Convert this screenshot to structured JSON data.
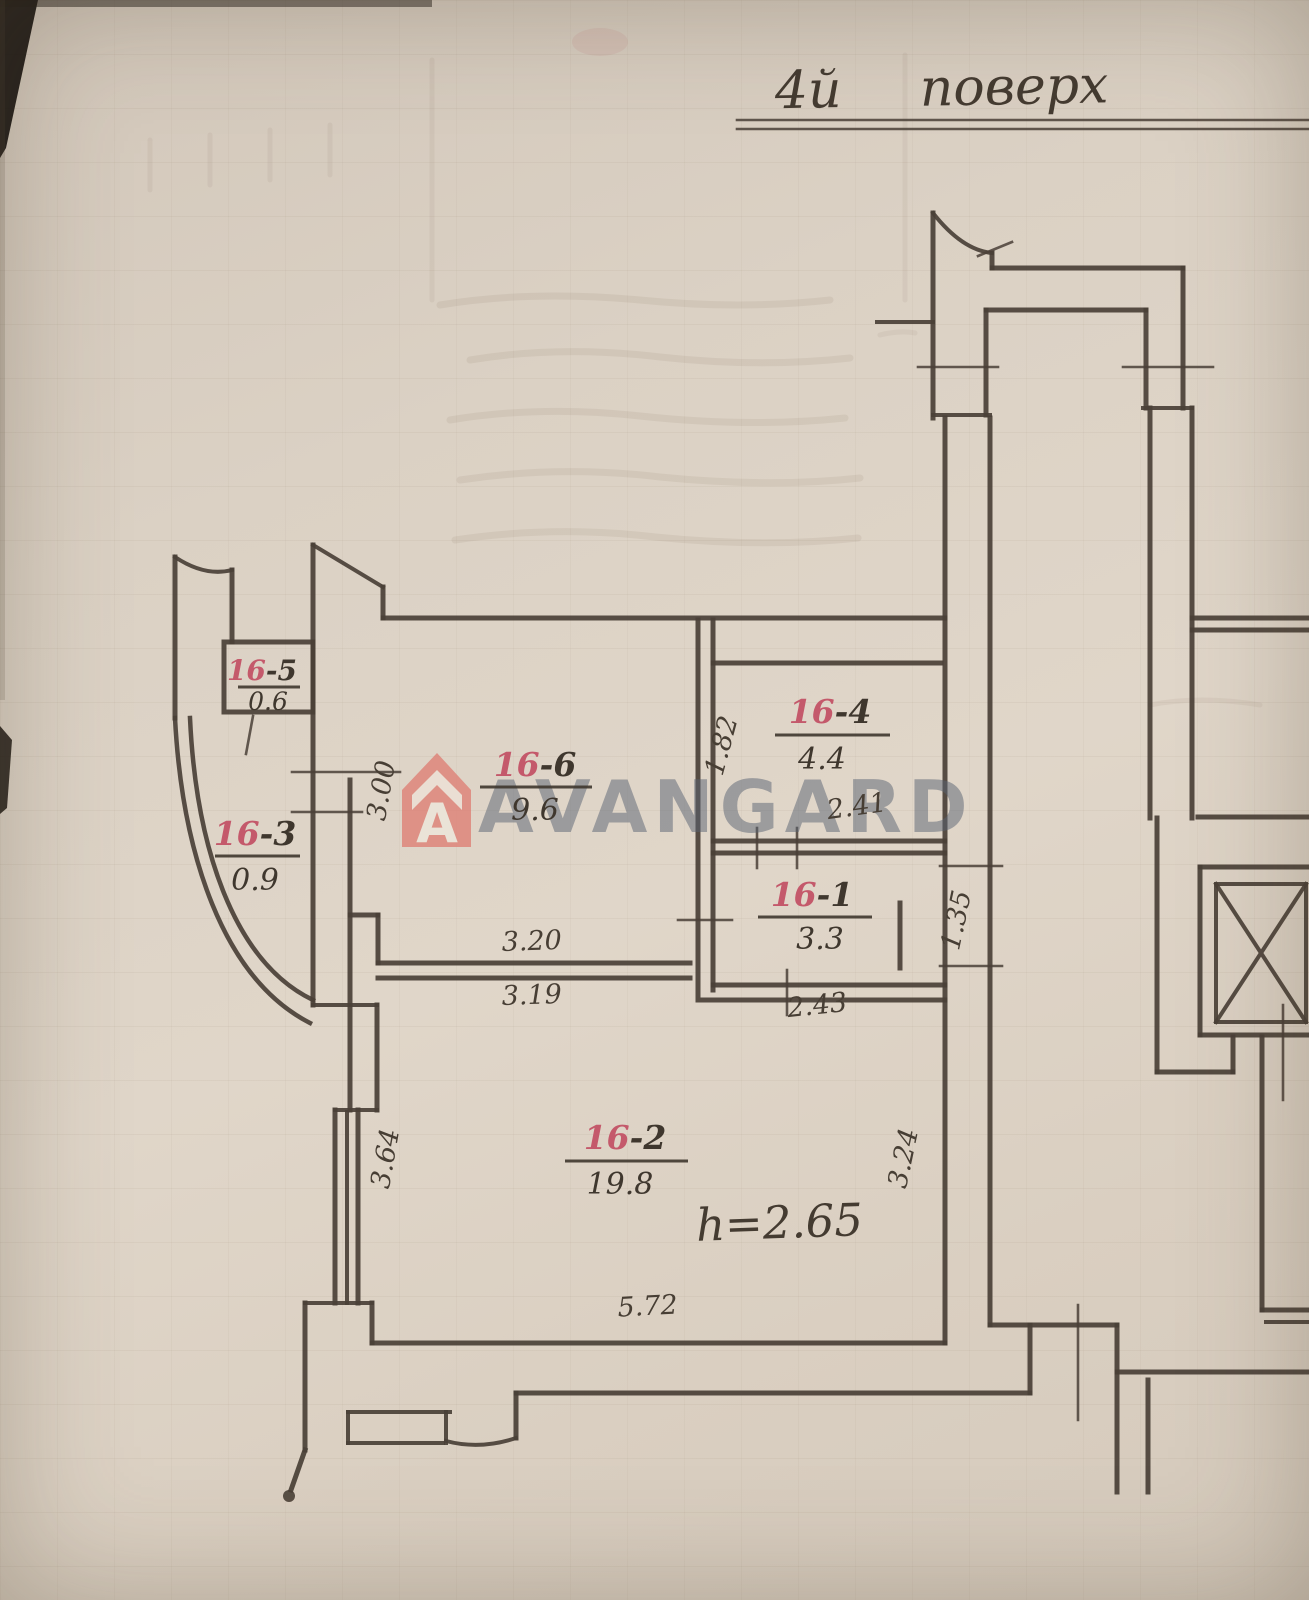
{
  "title": {
    "floor": "4й",
    "word": "поверх"
  },
  "rooms": {
    "r16_5": {
      "num": "16",
      "rest": "-5",
      "area": "0.6"
    },
    "r16_3": {
      "num": "16",
      "rest": "-3",
      "area": "0.9"
    },
    "r16_6": {
      "num": "16",
      "rest": "-6",
      "area": "9.6"
    },
    "r16_4": {
      "num": "16",
      "rest": "-4",
      "area": "4.4"
    },
    "r16_1": {
      "num": "16",
      "rest": "-1",
      "area": "3.3"
    },
    "r16_2": {
      "num": "16",
      "rest": "-2",
      "area": "19.8"
    }
  },
  "dims": {
    "hall_left": "3.00",
    "mid_wall_top": "3.20",
    "mid_wall_bottom": "3.19",
    "room4_left": "1.82",
    "room4_bottom": "2.41",
    "room1_bottom": "2.43",
    "entry_opening": "1.35",
    "room2_left": "3.64",
    "room2_right": "3.24",
    "room2_bottom": "5.72"
  },
  "notes": {
    "ceiling_height": "h=2.65"
  },
  "watermark": {
    "brand": "AVANGARD",
    "logo_letter": "A"
  },
  "colors": {
    "paper": "#d9cfc2",
    "ink": "#4a4037",
    "room_number_red": "#c4596b",
    "watermark_text": "#5a6472",
    "watermark_logo": "#dd8076"
  }
}
